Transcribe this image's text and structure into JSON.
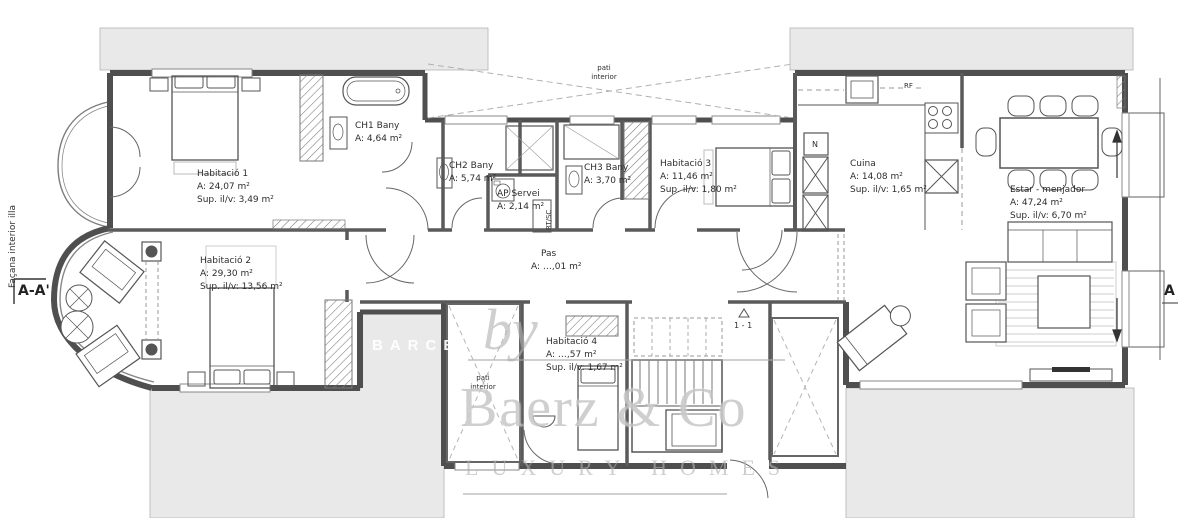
{
  "plan": {
    "type": "architectural-floor-plan",
    "units": "m²"
  },
  "rooms": [
    {
      "name": "Habitació 1",
      "area": "A: 24,07 m²",
      "sup": "Sup. il/v: 3,49 m²"
    },
    {
      "name": "CH1 Bany",
      "area": "A: 4,64 m²",
      "sup": ""
    },
    {
      "name": "CH2 Bany",
      "area": "A: 5,74 m²",
      "sup": ""
    },
    {
      "name": "AP Servei",
      "area": "A: 2,14 m²",
      "sup": ""
    },
    {
      "name": "CH3 Bany",
      "area": "A: 3,70 m²",
      "sup": ""
    },
    {
      "name": "Habitació 3",
      "area": "A: 11,46 m²",
      "sup": "Sup. il/v: 1,80 m²"
    },
    {
      "name": "Cuina",
      "area": "A: 14,08 m²",
      "sup": "Sup. il/v: 1,65 m²"
    },
    {
      "name": "Estar - menjador",
      "area": "A: 47,24 m²",
      "sup": "Sup. il/v: 6,70 m²"
    },
    {
      "name": "Habitació 2",
      "area": "A: 29,30 m²",
      "sup": "Sup. il/v: 13,56 m²"
    },
    {
      "name": "Pas",
      "area": "A: …,01 m²",
      "sup": ""
    },
    {
      "name": "Habitació 4",
      "area": "A: …,57 m²",
      "sup": "Sup. il/v: 1,67 m²"
    }
  ],
  "annotations": {
    "facade_label": "Façana interior illa",
    "section_marker_left": "A-A'",
    "section_marker_right": "A",
    "stair_marker": "1 - 1",
    "pati_line1": "pati",
    "pati_line2": "interior",
    "closet_label": "N",
    "fridge_label": "RF",
    "utility_label": "RT/SC"
  },
  "watermark": {
    "prefix": "by",
    "brand": "Baerz & Co",
    "tagline": "LUXURY HOMES",
    "side_text": "BARCE"
  }
}
